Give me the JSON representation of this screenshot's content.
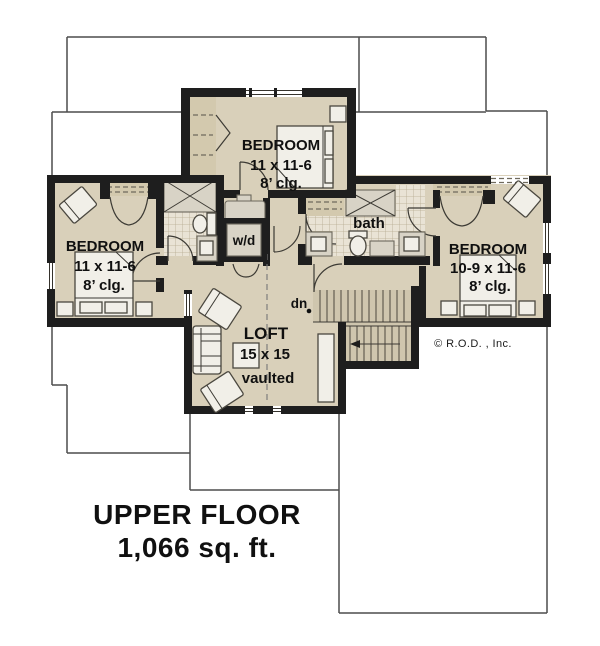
{
  "plan": {
    "bedroom_top": {
      "name": "BEDROOM",
      "dims": "11 x 11-6",
      "ceiling": "8’ clg."
    },
    "bedroom_left": {
      "name": "BEDROOM",
      "dims": "11 x 11-6",
      "ceiling": "8’ clg."
    },
    "bedroom_right": {
      "name": "BEDROOM",
      "dims": "10-9 x 11-6",
      "ceiling": "8’ clg."
    },
    "bath": {
      "name": "bath"
    },
    "laundry": {
      "name": "w/d"
    },
    "loft": {
      "name": "LOFT",
      "dims": "15 x 15",
      "ceiling": "vaulted"
    },
    "stair": {
      "label": "dn"
    }
  },
  "footer": {
    "title": "UPPER FLOOR",
    "area": "1,066 sq. ft."
  },
  "copyright": "© R.O.D. , Inc.",
  "colors": {
    "room_fill": "#d9d0ba",
    "wall": "#1e1e1e",
    "tile": "#e9e3d5",
    "stairs": "#cfc6ae",
    "outline": "#4d4d4d"
  }
}
